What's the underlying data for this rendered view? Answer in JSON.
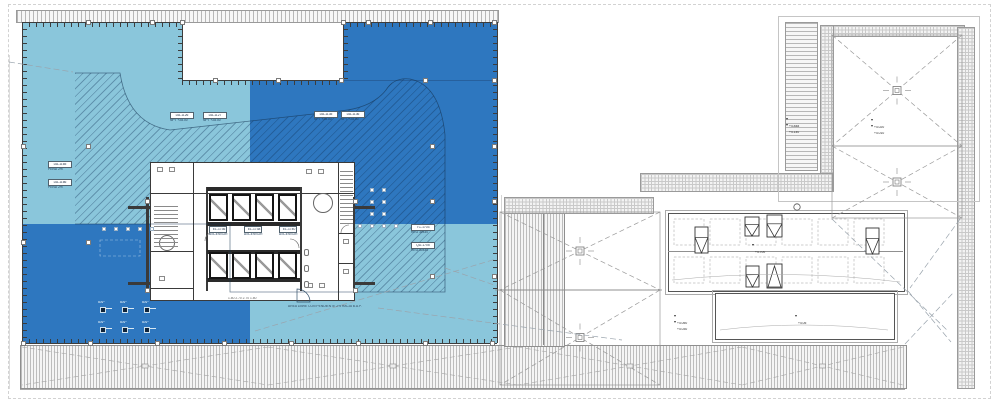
{
  "colors": {
    "quadrant_light": "#8AC6DB",
    "quadrant_dark": "#2E77BF"
  },
  "labels": {
    "boxes": [
      {
        "code": "DA-1126",
        "note": "NPT +28.00"
      },
      {
        "code": "DA-1127",
        "note": "NPT +28.00"
      },
      {
        "code": "DA-1135",
        "note": "NPT +28.00"
      },
      {
        "code": "DA-1136",
        "note": "NPT +28.00"
      },
      {
        "code": "DA-1165",
        "note": "PEND 2%"
      },
      {
        "code": "DA-1166",
        "note": "PEND 2%"
      },
      {
        "code": "TC-1703",
        "note": "REG 30x30"
      },
      {
        "code": "QD-1705",
        "note": "REG 30x30"
      }
    ],
    "core_boxes": [
      {
        "code": "EL-1736",
        "note": "ASCENSOR"
      },
      {
        "code": "EL-1738",
        "note": "ASCENSOR"
      },
      {
        "code": "EL-1740",
        "note": "ASCENSOR"
      }
    ],
    "drain": "BAP"
  },
  "elevations": [
    "+4.848",
    "+4.140",
    "+4.020",
    "+4.010",
    "+4.700",
    "+4.050",
    "+4.030",
    "+4.05"
  ],
  "note": "AREA LIBRE CON PENDIENTE 2% HACIA B.A.P.",
  "dims": "1.80   2.70   2.70   1.80"
}
